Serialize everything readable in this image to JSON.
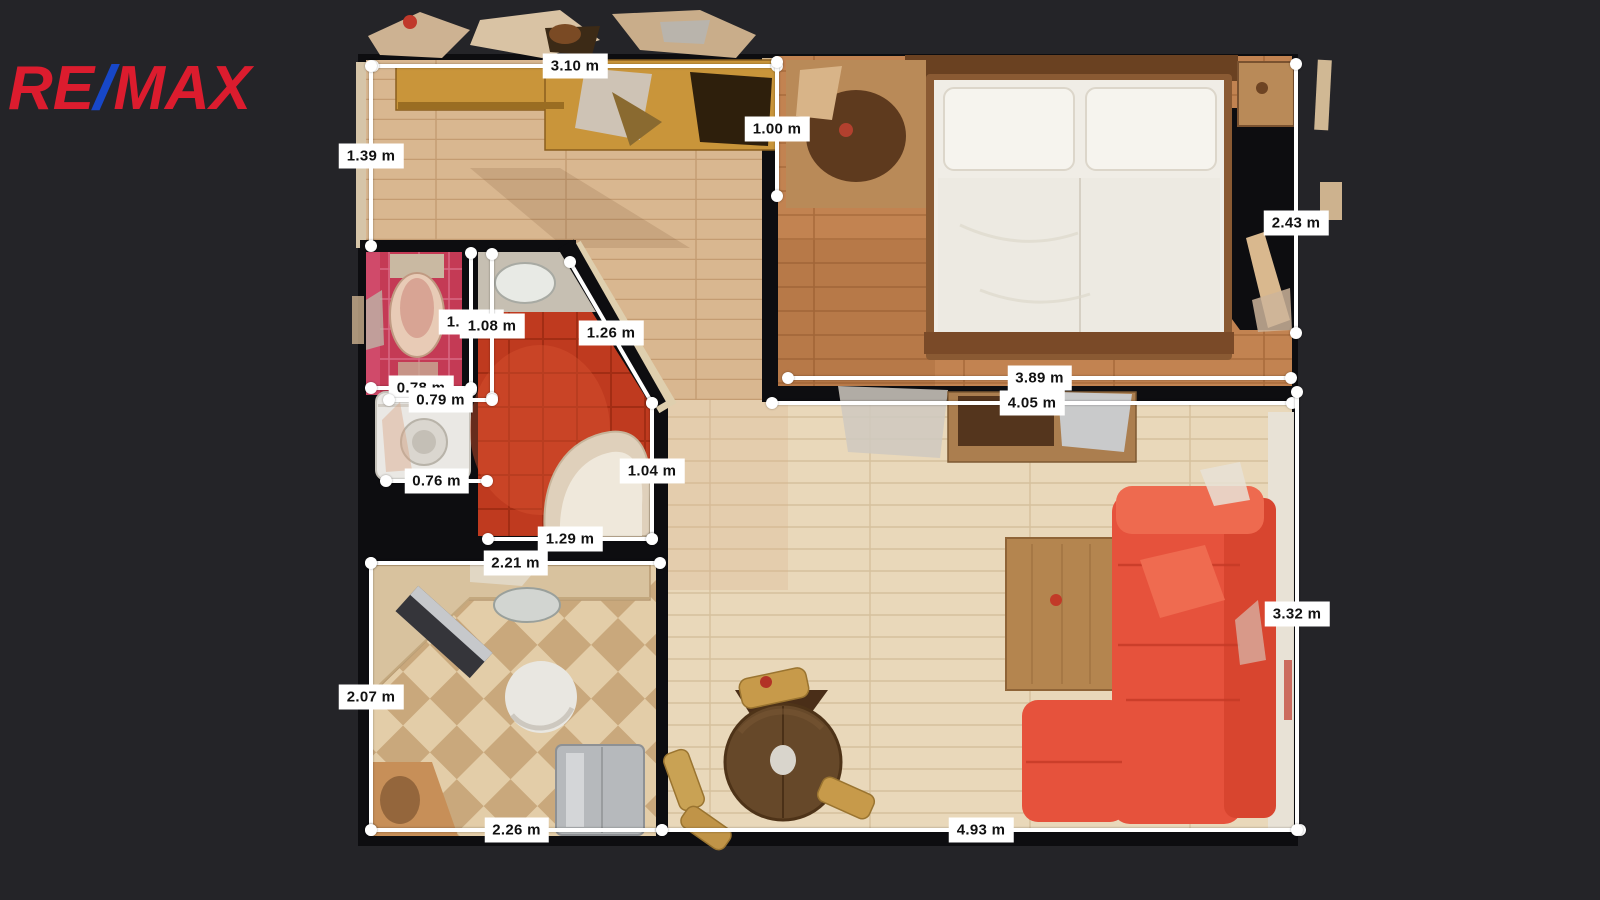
{
  "logo": {
    "re": "RE",
    "slash": "/",
    "max": "MAX"
  },
  "colors": {
    "background": "#242428",
    "wall": "#0d0d10",
    "measure_line": "#ffffff",
    "label_bg": "#ffffff",
    "label_text": "#111111",
    "logo_red": "#dc1c2e",
    "logo_blue": "#1747c8",
    "hall_floor": "#d9b790",
    "bedroom_floor": "#c28351",
    "living_floor": "#e9d8ba",
    "kitchen_tile_light": "#e3cda8",
    "kitchen_tile_dark": "#c9a87c",
    "bath_tile": "#bf3a1f",
    "wc_tile": "#c43a55",
    "sofa": "#e6523c",
    "wardrobe": "#c9953a",
    "bed": "#f0ede6"
  },
  "plan": {
    "measurements": [
      {
        "name": "hall-width",
        "label": "3.10 m",
        "x1": 373,
        "y1": 66,
        "x2": 777,
        "y2": 66
      },
      {
        "name": "hall-depth",
        "label": "1.39 m",
        "x1": 371,
        "y1": 66,
        "x2": 371,
        "y2": 246
      },
      {
        "name": "hall-right-depth",
        "label": "1.00 m",
        "x1": 777,
        "y1": 62,
        "x2": 777,
        "y2": 196
      },
      {
        "name": "bedroom-right-depth",
        "label": "2.43 m",
        "x1": 1296,
        "y1": 64,
        "x2": 1296,
        "y2": 333,
        "ly": 223
      },
      {
        "name": "bedroom-width",
        "label": "3.89 m",
        "x1": 788,
        "y1": 378,
        "x2": 1291,
        "y2": 378
      },
      {
        "name": "living-width-top",
        "label": "4.05 m",
        "x1": 772,
        "y1": 403,
        "x2": 1292,
        "y2": 403
      },
      {
        "name": "wc-height-a",
        "label": "1.04 m",
        "x1": 471,
        "y1": 253,
        "x2": 471,
        "y2": 390
      },
      {
        "name": "wc-height-b",
        "label": "1.08 m",
        "x1": 492,
        "y1": 254,
        "x2": 492,
        "y2": 398
      },
      {
        "name": "bath-diagonal",
        "label": "1.26 m",
        "x1": 570,
        "y1": 262,
        "x2": 652,
        "y2": 403
      },
      {
        "name": "wc-width-a",
        "label": "0.78 m",
        "x1": 371,
        "y1": 388,
        "x2": 471,
        "y2": 388
      },
      {
        "name": "wc-width-b",
        "label": "0.79 m",
        "x1": 389,
        "y1": 400,
        "x2": 492,
        "y2": 400
      },
      {
        "name": "laundry-width",
        "label": "0.76 m",
        "x1": 386,
        "y1": 481,
        "x2": 487,
        "y2": 481
      },
      {
        "name": "bath-right-height",
        "label": "1.04 m",
        "x1": 652,
        "y1": 403,
        "x2": 652,
        "y2": 539
      },
      {
        "name": "bath-width",
        "label": "1.29 m",
        "x1": 488,
        "y1": 539,
        "x2": 652,
        "y2": 539
      },
      {
        "name": "kitchen-width-top",
        "label": "2.21 m",
        "x1": 371,
        "y1": 563,
        "x2": 660,
        "y2": 563
      },
      {
        "name": "kitchen-depth",
        "label": "2.07 m",
        "x1": 371,
        "y1": 563,
        "x2": 371,
        "y2": 830
      },
      {
        "name": "kitchen-width-bottom",
        "label": "2.26 m",
        "x1": 371,
        "y1": 830,
        "x2": 662,
        "y2": 830
      },
      {
        "name": "living-width-bottom",
        "label": "4.93 m",
        "x1": 662,
        "y1": 830,
        "x2": 1300,
        "y2": 830
      },
      {
        "name": "living-right-depth",
        "label": "3.32 m",
        "x1": 1297,
        "y1": 392,
        "x2": 1297,
        "y2": 830,
        "ly": 614
      }
    ]
  }
}
